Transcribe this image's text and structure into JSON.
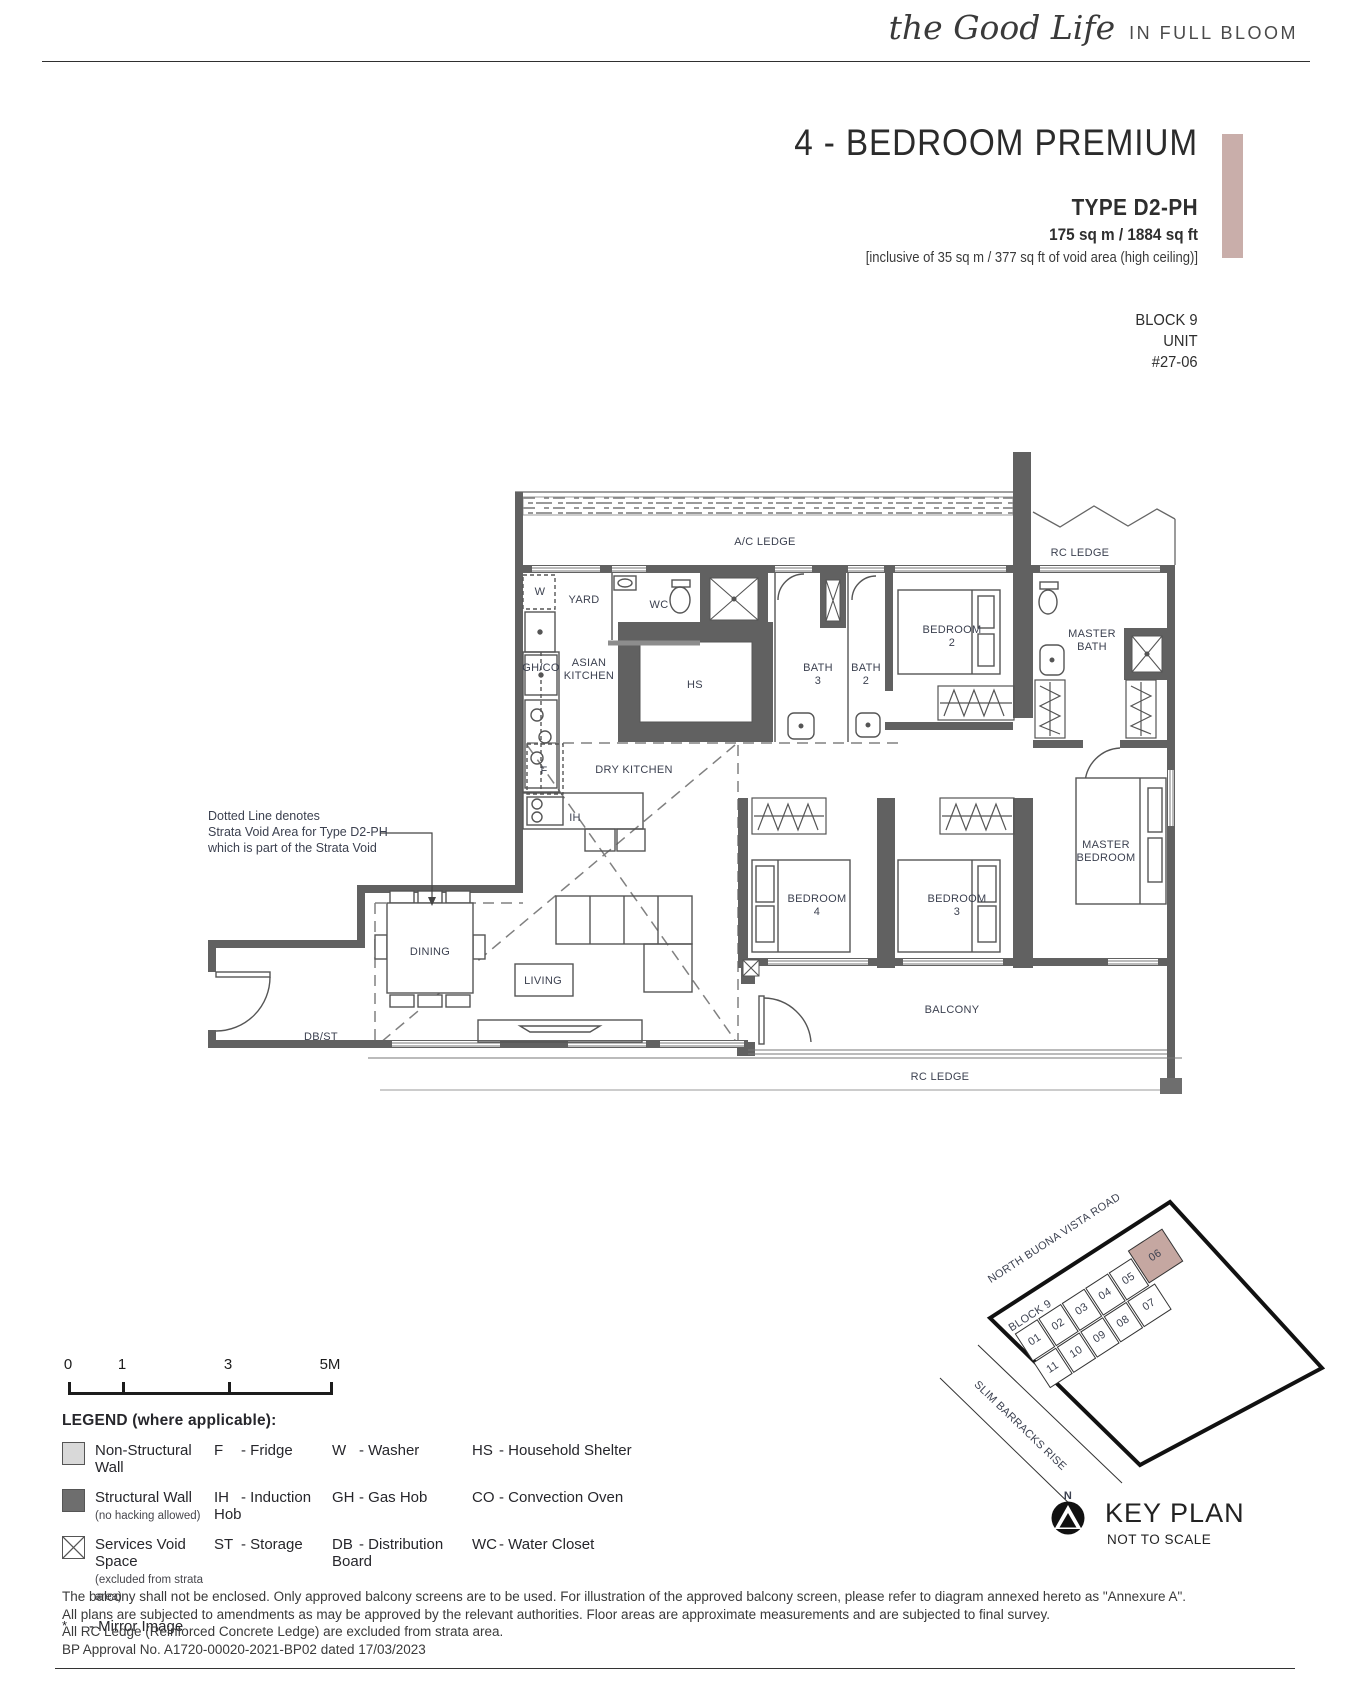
{
  "header": {
    "logo_script": "the Good Life",
    "logo_tagline": "IN FULL BLOOM"
  },
  "title_block": {
    "title": "4 - BEDROOM PREMIUM",
    "type": "TYPE D2-PH",
    "area": "175 sq m / 1884 sq ft",
    "area_note": "[inclusive of 35 sq m / 377 sq ft of void area (high ceiling)]",
    "block": "BLOCK 9",
    "unit_label": "UNIT",
    "unit_number": "#27-06",
    "accent_color": "#c9aeaa"
  },
  "floorplan": {
    "annotation_lines": [
      "Dotted Line denotes",
      "Strata Void Area for Type D2-PH",
      "which is part of the Strata Void"
    ],
    "room_labels": [
      {
        "label": "A/C LEDGE",
        "x": 765,
        "y": 545
      },
      {
        "label": "RC LEDGE",
        "x": 1080,
        "y": 556
      },
      {
        "label": "W",
        "x": 540,
        "y": 595,
        "size": 10
      },
      {
        "label": "YARD",
        "x": 584,
        "y": 603
      },
      {
        "label": "WC",
        "x": 659,
        "y": 608
      },
      {
        "label": "GH/CO",
        "x": 541,
        "y": 671,
        "size": 9
      },
      {
        "label": "ASIAN\nKITCHEN",
        "x": 589,
        "y": 666
      },
      {
        "label": "HS",
        "x": 695,
        "y": 688
      },
      {
        "label": "BATH\n3",
        "x": 818,
        "y": 671
      },
      {
        "label": "BATH\n2",
        "x": 866,
        "y": 671
      },
      {
        "label": "BEDROOM\n2",
        "x": 952,
        "y": 633
      },
      {
        "label": "MASTER\nBATH",
        "x": 1092,
        "y": 637
      },
      {
        "label": "F",
        "x": 544,
        "y": 774,
        "size": 10
      },
      {
        "label": "DRY KITCHEN",
        "x": 634,
        "y": 773
      },
      {
        "label": "IH",
        "x": 575,
        "y": 821,
        "size": 10
      },
      {
        "label": "DINING",
        "x": 430,
        "y": 955
      },
      {
        "label": "LIVING",
        "x": 543,
        "y": 984
      },
      {
        "label": "DB/ST",
        "x": 321,
        "y": 1040,
        "size": 10
      },
      {
        "label": "BEDROOM\n4",
        "x": 817,
        "y": 902
      },
      {
        "label": "BEDROOM\n3",
        "x": 957,
        "y": 902
      },
      {
        "label": "MASTER\nBEDROOM",
        "x": 1106,
        "y": 848
      },
      {
        "label": "BALCONY",
        "x": 952,
        "y": 1013
      },
      {
        "label": "RC LEDGE",
        "x": 940,
        "y": 1080
      }
    ]
  },
  "scale_bar": {
    "labels": [
      "0",
      "1",
      "3",
      "5M"
    ]
  },
  "legend": {
    "heading": "LEGEND (where applicable):",
    "wall_items": [
      {
        "label": "Non-Structural Wall",
        "sub": "",
        "type": "light"
      },
      {
        "label": "Structural Wall",
        "sub": "(no hacking allowed)",
        "type": "dark"
      },
      {
        "label": "Services Void Space",
        "sub": "(excluded from strata area)",
        "type": "void"
      }
    ],
    "abbr_cols": [
      [
        {
          "k": "F",
          "v": "- Fridge"
        },
        {
          "k": "IH",
          "v": "- Induction Hob"
        },
        {
          "k": "ST",
          "v": "- Storage"
        }
      ],
      [
        {
          "k": "W",
          "v": "- Washer"
        },
        {
          "k": "GH",
          "v": "- Gas Hob"
        },
        {
          "k": "DB",
          "v": "- Distribution Board"
        }
      ],
      [
        {
          "k": "HS",
          "v": "- Household Shelter"
        },
        {
          "k": "CO",
          "v": "- Convection Oven"
        },
        {
          "k": "WC",
          "v": "- Water Closet"
        }
      ]
    ],
    "mirror_note": {
      "k": "*",
      "v": "- Mirror Image"
    }
  },
  "key_plan": {
    "title": "KEY PLAN",
    "subtitle": "NOT TO SCALE",
    "north_label": "N",
    "roads": [
      "NORTH BUONA VISTA ROAD",
      "SLIM BARRACKS RISE"
    ],
    "block_label": "BLOCK 9",
    "unit_numbers": [
      "01",
      "02",
      "03",
      "04",
      "05",
      "06",
      "07",
      "08",
      "09",
      "10",
      "11"
    ],
    "highlighted_unit": "06",
    "highlight_color": "#c5a7a1"
  },
  "notes": [
    "The balcony shall not be enclosed. Only approved balcony screens are to be used. For illustration of the approved balcony screen, please refer to diagram annexed hereto as \"Annexure A\".",
    "All plans are subjected to amendments as may be approved by the relevant authorities. Floor areas are approximate measurements and are subjected to final survey.",
    "All RC Ledge (Reinforced Concrete Ledge) are excluded from strata area.",
    "BP Approval No. A1720-00020-2021-BP02 dated 17/03/2023"
  ]
}
